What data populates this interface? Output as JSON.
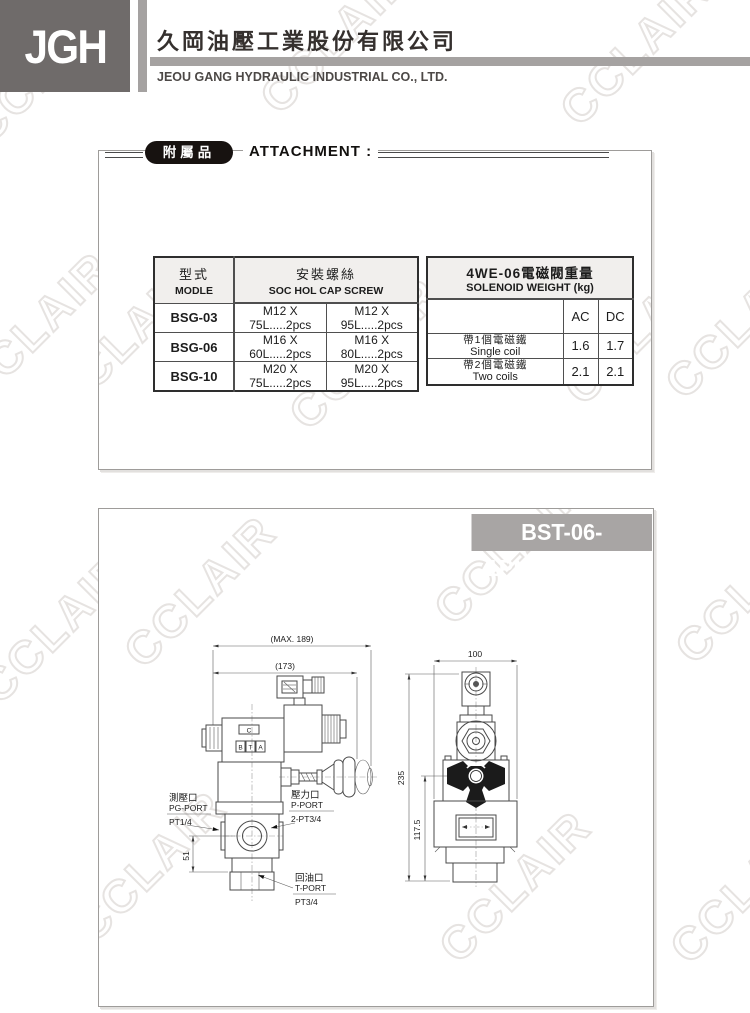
{
  "page": {
    "watermark": "CCLAIR"
  },
  "header": {
    "logo": "JGH",
    "company_zh": "久岡油壓工業股份有限公司",
    "company_en": "JEOU GANG HYDRAULIC INDUSTRIAL CO., LTD."
  },
  "attachment": {
    "badge": "附屬品",
    "title": "ATTACHMENT :",
    "screw_table": {
      "col_model_zh": "型式",
      "col_model_en": "MODLE",
      "col_screw_zh": "安裝螺絲",
      "col_screw_en": "SOC HOL CAP SCREW",
      "rows": [
        {
          "model": "BSG-03",
          "screw1": "M12 X 75L.....2pcs",
          "screw2": "M12 X 95L.....2pcs"
        },
        {
          "model": "BSG-06",
          "screw1": "M16 X 60L.....2pcs",
          "screw2": "M16 X 80L.....2pcs"
        },
        {
          "model": "BSG-10",
          "screw1": "M20 X 75L.....2pcs",
          "screw2": "M20 X 95L.....2pcs"
        }
      ]
    },
    "weight_table": {
      "title_zh": "4WE-06電磁閥重量",
      "title_en": "SOLENOID WEIGHT  (kg)",
      "col_ac": "AC",
      "col_dc": "DC",
      "rows": [
        {
          "label_zh": "帶1個電磁鐵",
          "label_en": "Single coil",
          "ac": "1.6",
          "dc": "1.7"
        },
        {
          "label_zh": "帶2個電磁鐵",
          "label_en": "Two coils",
          "ac": "2.1",
          "dc": "2.1"
        }
      ]
    }
  },
  "drawing": {
    "banner": "BST-06-1PN/1NP.....DC",
    "side_view": {
      "dim_max": "(MAX. 189)",
      "dim_width": "(173)",
      "dim_51": "51",
      "mark_c": "C",
      "mark_b": "B",
      "mark_t": "T",
      "mark_a": "A",
      "port_pg_zh": "測壓口",
      "port_pg_en": "PG-PORT",
      "port_pg_size": "PT1/4",
      "port_p_zh": "壓力口",
      "port_p_en": "P-PORT",
      "port_p_size": "2-PT3/4",
      "port_t_zh": "回油口",
      "port_t_en": "T-PORT",
      "port_t_size": "PT3/4"
    },
    "front_view": {
      "dim_width": "100",
      "dim_height": "235",
      "dim_mid": "117.5"
    }
  },
  "colors": {
    "logo_bg": "#6f6b6a",
    "header_bar": "#a5a2a1",
    "banner_bg": "#a8a5a4",
    "table_header_bg": "#f1efed",
    "watermark_outline": "#e6e3e1"
  }
}
